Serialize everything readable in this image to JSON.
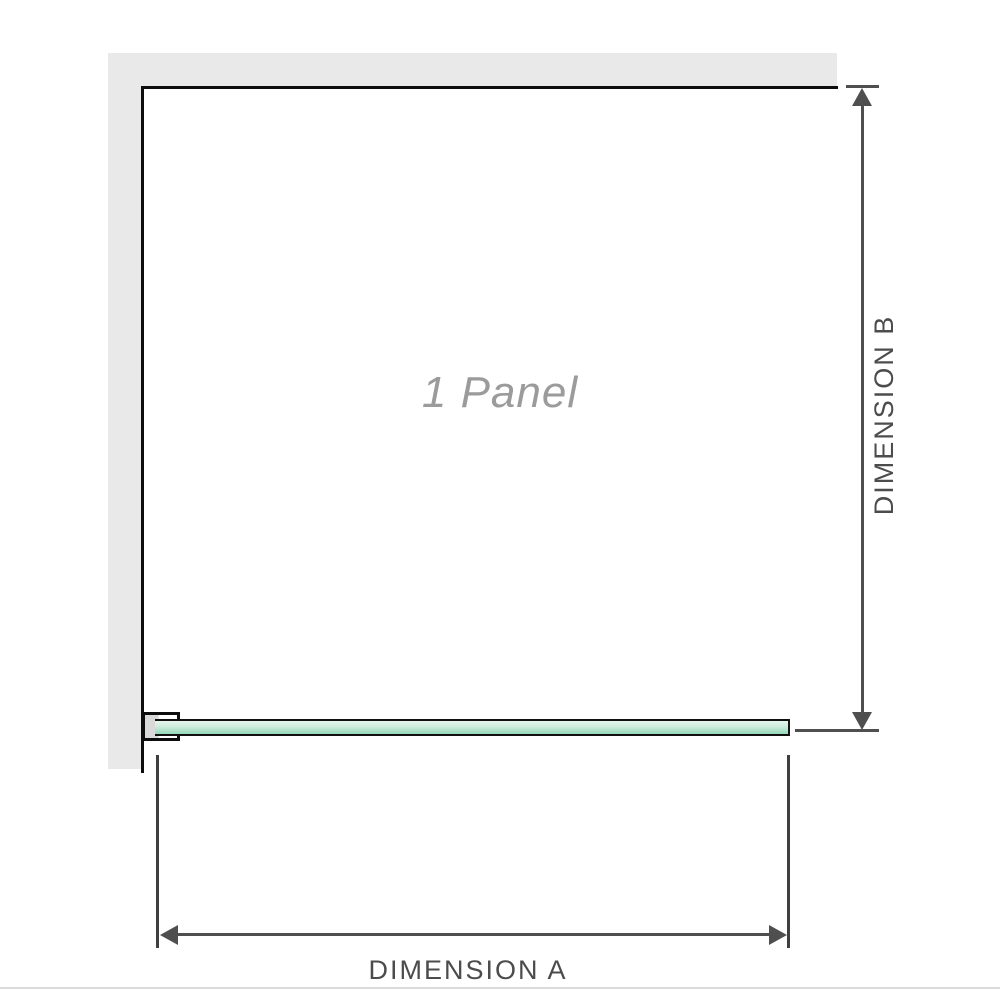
{
  "labels": {
    "panel": "1 Panel",
    "dimension_a": "DIMENSION A",
    "dimension_b": "DIMENSION B"
  },
  "panel_count": 1,
  "colors": {
    "wall": "#e9e9e9",
    "frame": "#0d0d0d",
    "glass_light": "#e6f5ee",
    "glass_dark": "#97d8b9",
    "dimension_line": "#4f4f4f",
    "extension_line": "#3f3f3f",
    "label_text": "#4c4c4c",
    "panel_label_text": "#9b9b9b",
    "baseline": "#dbdbdb"
  }
}
